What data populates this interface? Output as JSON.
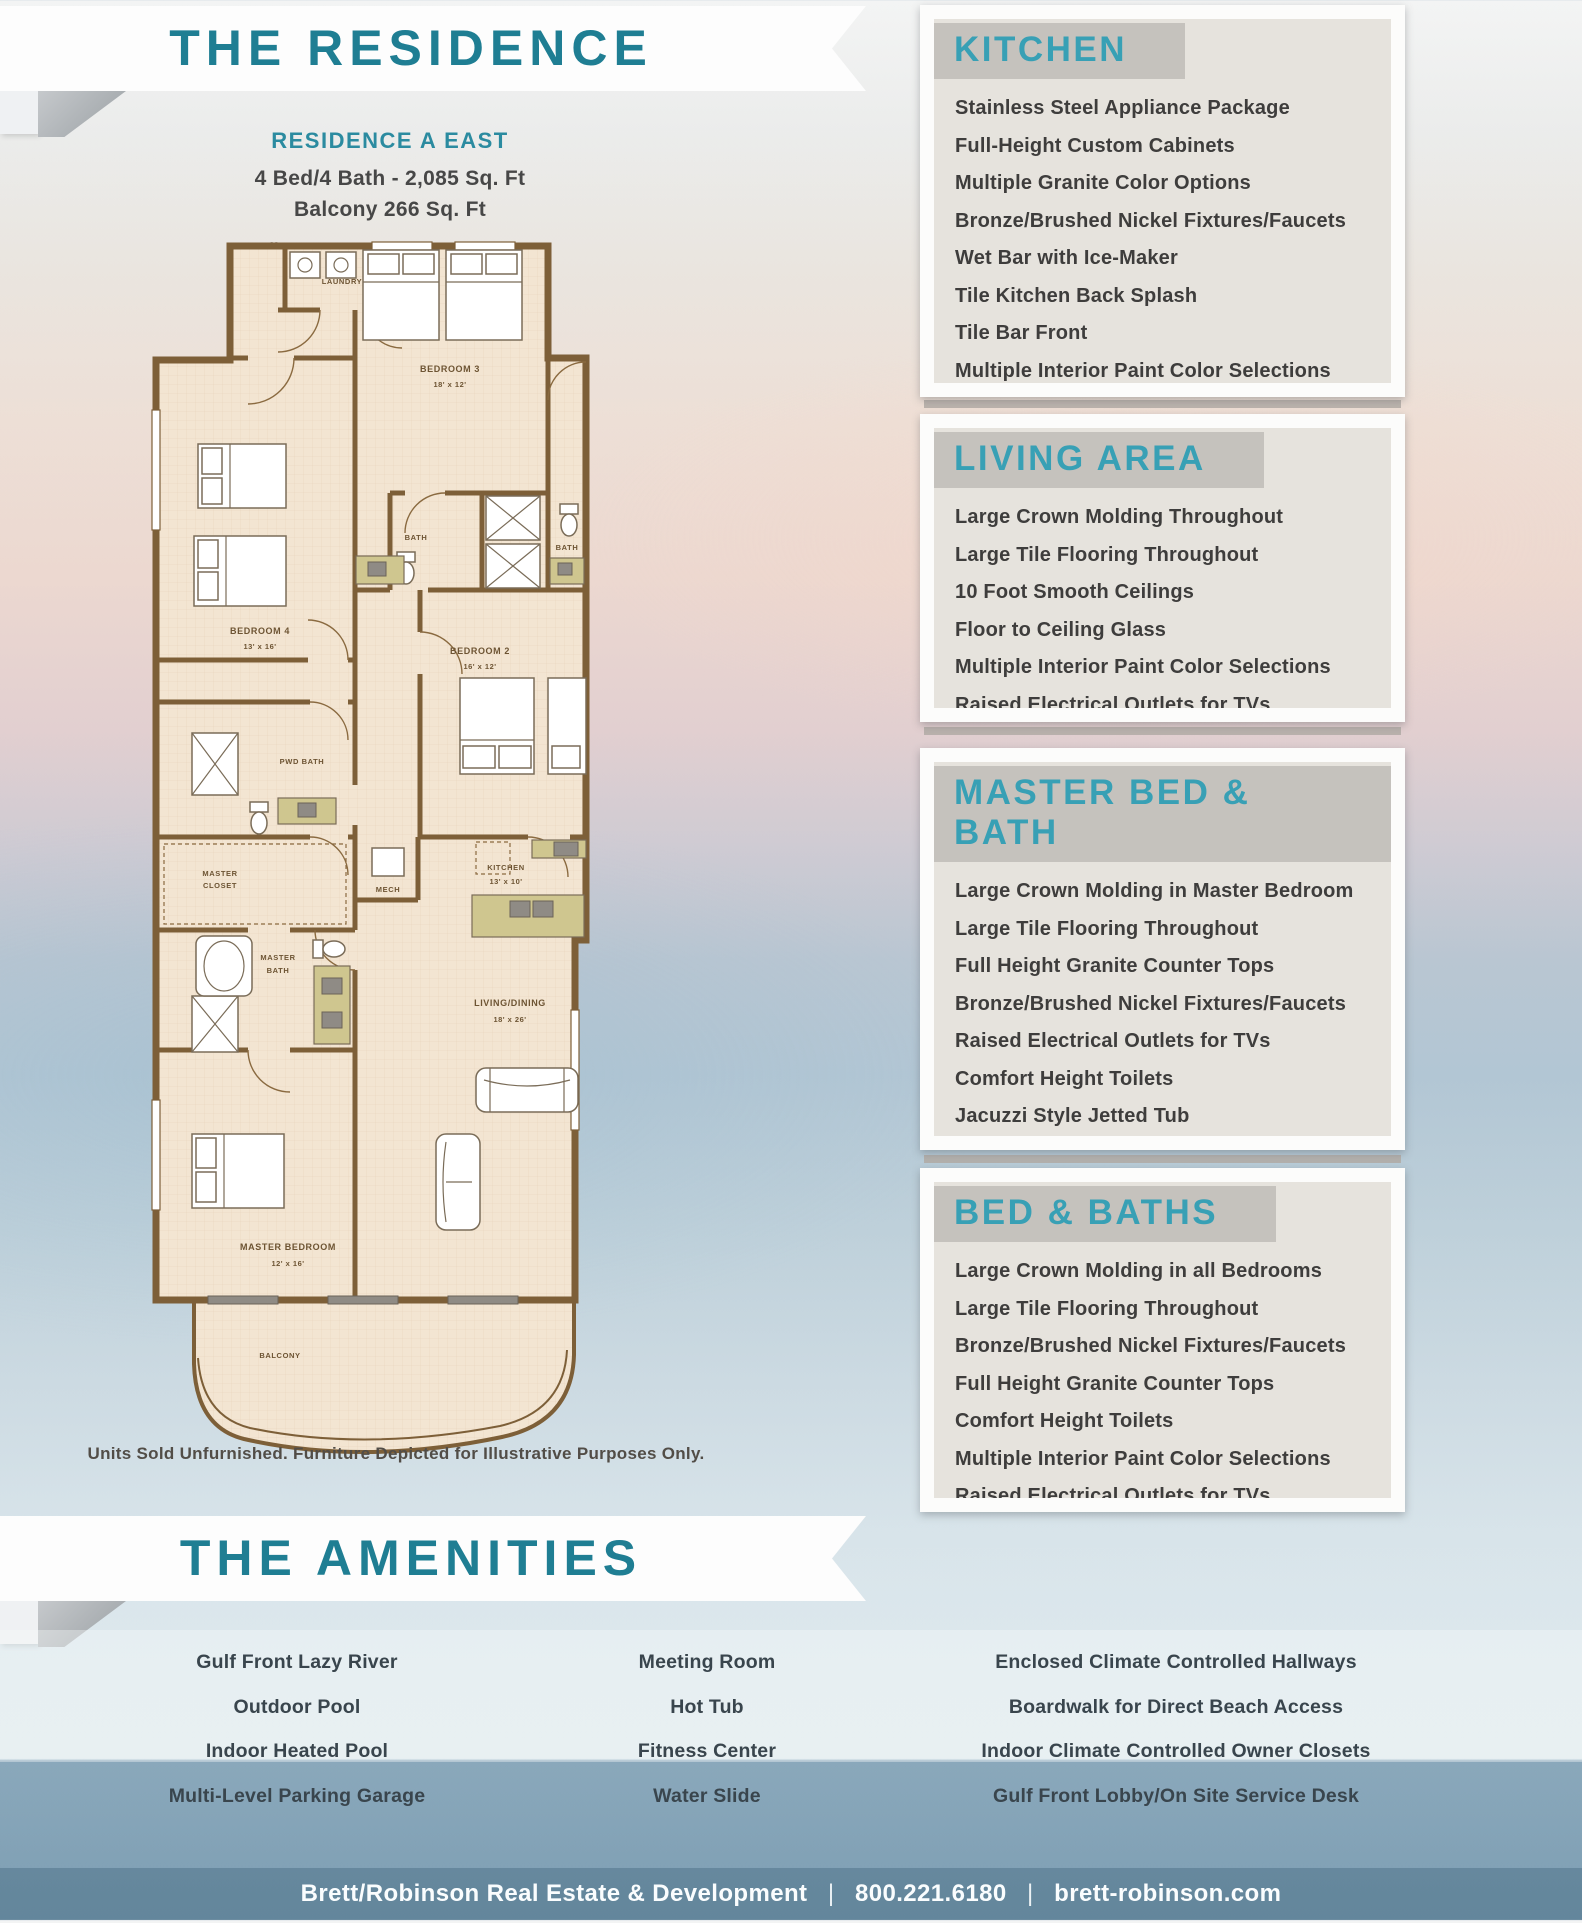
{
  "colors": {
    "title_teal": "#1f7e93",
    "header_teal": "#38a0b5",
    "name_teal": "#2b8ba0",
    "body_text": "#3e3d3c",
    "wall_brown": "#7d5f38",
    "floor_tan": "#f3e5d2"
  },
  "banners": {
    "residence": "THE RESIDENCE",
    "amenities": "THE AMENITIES"
  },
  "residence": {
    "name": "RESIDENCE A EAST",
    "spec_line1": "4 Bed/4 Bath - 2,085 Sq. Ft",
    "spec_line2": "Balcony 266 Sq. Ft",
    "disclaimer": "All Measurements are Approximate",
    "floorplan_note": "Units Sold Unfurnished. Furniture Depicted for Illustrative Purposes Only."
  },
  "floorplan": {
    "rooms": [
      {
        "line1": "LAUNDRY"
      },
      {
        "line1": "BEDROOM 3",
        "dims": "18' x 12'"
      },
      {
        "line1": "BATH"
      },
      {
        "line1": "BATH"
      },
      {
        "line1": "BEDROOM 4",
        "dims": "13' x 16'"
      },
      {
        "line1": "BEDROOM 2",
        "dims": "16' x 12'"
      },
      {
        "line1": "PWD BATH"
      },
      {
        "line1": "MASTER",
        "line2": "CLOSET"
      },
      {
        "line1": "MECH"
      },
      {
        "line1": "KITCHEN",
        "dims": "13' x 10'"
      },
      {
        "line1": "MASTER",
        "line2": "BATH"
      },
      {
        "line1": "LIVING/DINING",
        "dims": "18' x 26'"
      },
      {
        "line1": "MASTER BEDROOM",
        "dims": "12' x 16'"
      },
      {
        "line1": "BALCONY"
      }
    ]
  },
  "sections": [
    {
      "title": "KITCHEN",
      "items": [
        "Stainless Steel Appliance Package",
        "Full-Height Custom Cabinets",
        "Multiple Granite Color Options",
        "Bronze/Brushed Nickel Fixtures/Faucets",
        "Wet Bar with Ice-Maker",
        "Tile Kitchen Back Splash",
        "Tile Bar Front",
        "Multiple Interior Paint Color Selections"
      ]
    },
    {
      "title": "LIVING AREA",
      "items": [
        "Large Crown Molding Throughout",
        "Large Tile Flooring Throughout",
        "10 Foot Smooth Ceilings",
        "Floor to Ceiling Glass",
        "Multiple Interior Paint Color Selections",
        "Raised Electrical Outlets for TVs"
      ]
    },
    {
      "title": "MASTER BED & BATH",
      "items": [
        "Large Crown Molding in Master Bedroom",
        "Large Tile Flooring Throughout",
        "Full Height Granite Counter Tops",
        "Bronze/Brushed Nickel Fixtures/Faucets",
        "Raised Electrical Outlets for TVs",
        "Comfort Height Toilets",
        "Jacuzzi Style Jetted Tub",
        "Multiple Interior Paint Color Selections"
      ]
    },
    {
      "title": "BED & BATHS",
      "items": [
        "Large Crown Molding in all Bedrooms",
        "Large Tile Flooring Throughout",
        "Bronze/Brushed Nickel Fixtures/Faucets",
        "Full Height Granite Counter Tops",
        "Comfort Height Toilets",
        "Multiple Interior Paint Color Selections",
        "Raised Electrical Outlets for TVs"
      ]
    }
  ],
  "amenities": {
    "columns": [
      [
        "Gulf Front Lazy River",
        "Outdoor Pool",
        "Indoor Heated Pool",
        "Multi-Level Parking Garage"
      ],
      [
        "Meeting Room",
        "Hot Tub",
        "Fitness Center",
        "Water Slide"
      ],
      [
        "Enclosed Climate Controlled Hallways",
        "Boardwalk for Direct Beach Access",
        "Indoor Climate Controlled Owner Closets",
        "Gulf Front Lobby/On Site Service Desk"
      ]
    ]
  },
  "footer": {
    "company": "Brett/Robinson Real Estate & Development",
    "separator": "|",
    "phone": "800.221.6180",
    "website": "brett-robinson.com"
  }
}
